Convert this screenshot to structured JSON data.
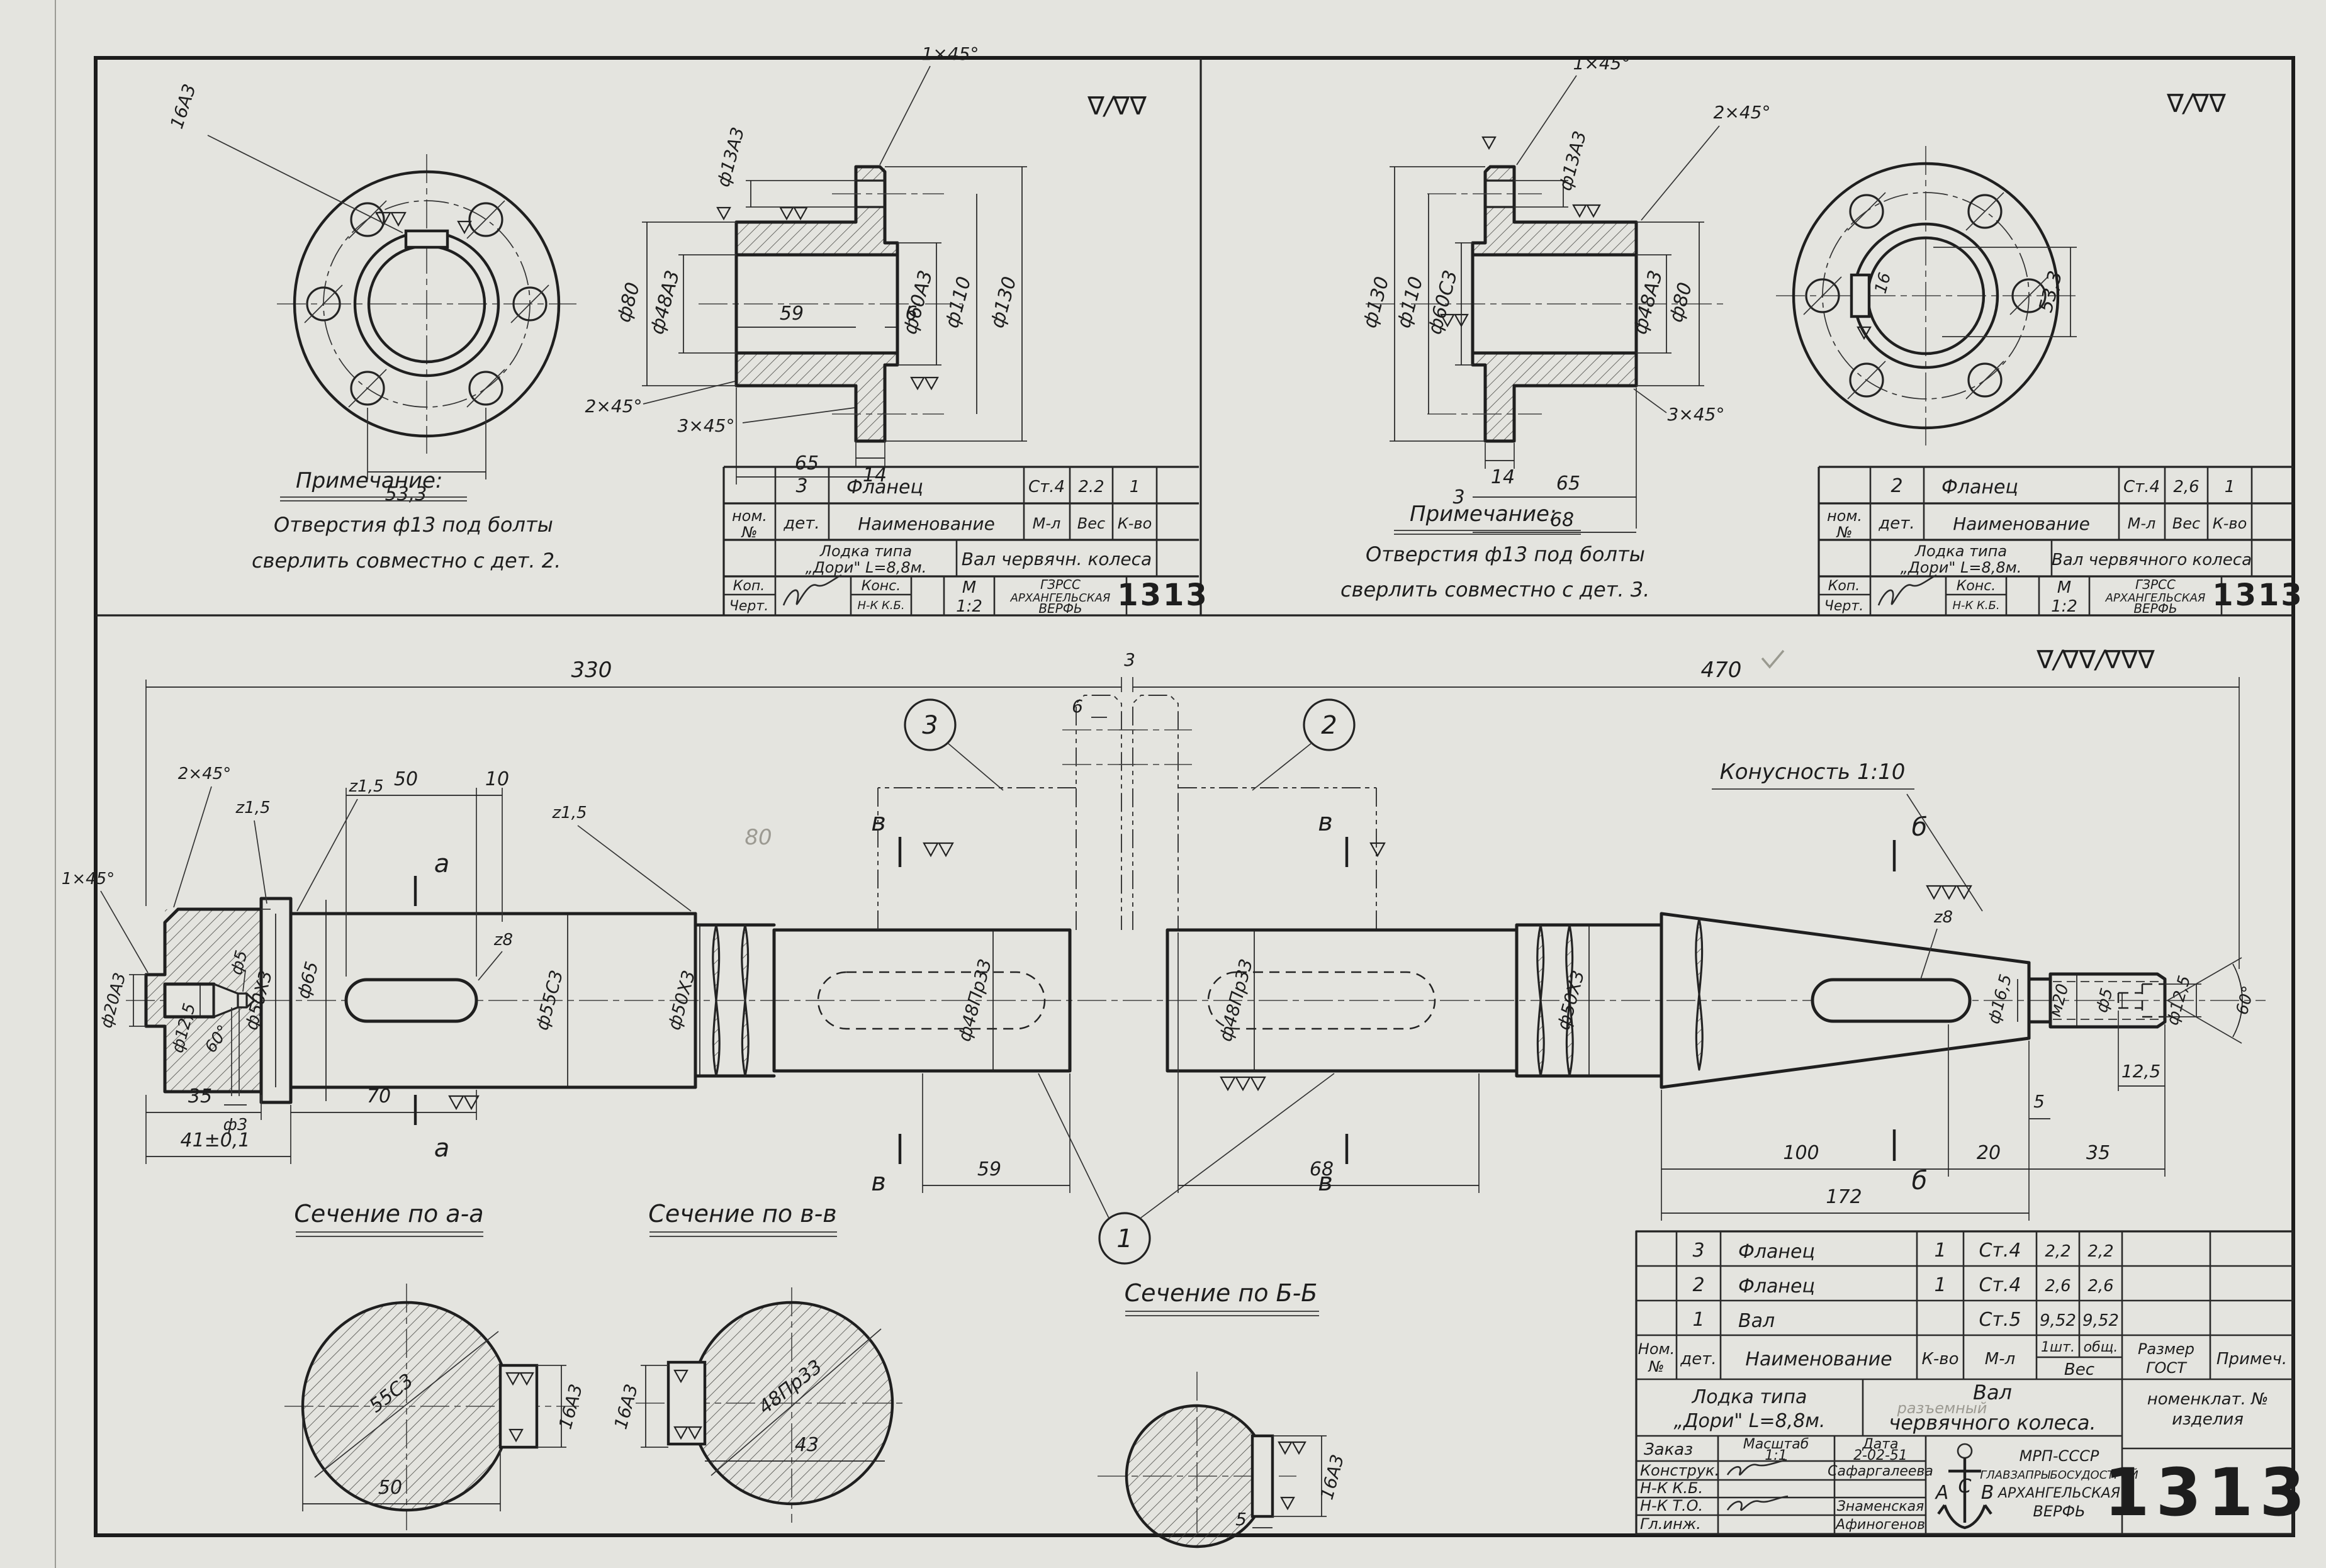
{
  "finish": {
    "tl": "∇/∇∇",
    "tr": "∇/∇∇",
    "main": "∇/∇∇/∇∇∇"
  },
  "flange3": {
    "note": {
      "title": "Примечание:",
      "line1": "Отверстия ф13 под болты",
      "line2": "сверлить совместно с дет. 2."
    },
    "front": {
      "bolt_dim": "53,3",
      "keyway_dim": "16А3"
    },
    "section": {
      "chamfer1": "1×45°",
      "hole": "ф13А3",
      "d80": "ф80",
      "d48": "ф48А3",
      "len59": "59",
      "len6": "6",
      "d60": "ф60А3",
      "d110": "ф110",
      "d130": "ф130",
      "chamfer2": "2×45°",
      "chamfer3": "3×45°",
      "len14": "14",
      "len65": "65"
    },
    "tb": {
      "num": "3",
      "name": "Фланец",
      "mat": "Ст.4",
      "weight": "2.2",
      "qty": "1",
      "h_nom": "ном.",
      "h_no": "№",
      "h_det": "дет.",
      "h_name": "Наименование",
      "h_mat": "М-л",
      "h_ves": "Вес",
      "h_kvo": "К-во",
      "proj1": "Лодка типа",
      "proj2": "„Дори\" L=8,8м.",
      "part": "Вал червячн. колеса",
      "kop": "Коп.",
      "chert": "Черт.",
      "kons": "Конс.",
      "nkkb": "Н-К К.Б.",
      "m": "М",
      "scale": "1:2",
      "org1": "ГЗРСС",
      "org2": "АРХАНГЕЛЬСКАЯ",
      "org3": "ВЕРФЬ",
      "number": "1313"
    }
  },
  "flange2": {
    "note": {
      "title": "Примечание:",
      "line1": "Отверстия ф13 под болты",
      "line2": "сверлить совместно с дет. 3."
    },
    "front": {
      "bolt_dim": "53,3",
      "keyway_dim": "16"
    },
    "section": {
      "chamfer1": "1×45°",
      "hole": "ф13А3",
      "chamfer2": "2×45°",
      "d130": "ф130",
      "d110": "ф110",
      "d60": "ф60С3",
      "d48": "ф48А3",
      "d80": "ф80",
      "chamfer3": "3×45°",
      "len14": "14",
      "len3": "3",
      "len65": "65",
      "len68": "68"
    },
    "tb": {
      "num": "2",
      "name": "Фланец",
      "mat": "Ст.4",
      "weight": "2,6",
      "qty": "1",
      "h_nom": "ном.",
      "h_no": "№",
      "h_det": "дет.",
      "h_name": "Наименование",
      "h_mat": "М-л",
      "h_ves": "Вес",
      "h_kvo": "К-во",
      "proj1": "Лодка типа",
      "proj2": "„Дори\" L=8,8м.",
      "part": "Вал червячного колеса",
      "kop": "Коп.",
      "chert": "Черт.",
      "kons": "Конс.",
      "nkkb": "Н-К К.Б.",
      "m": "М",
      "scale": "1:2",
      "org1": "ГЗРСС",
      "org2": "АРХАНГЕЛЬСКАЯ",
      "org3": "ВЕРФЬ",
      "number": "1313"
    }
  },
  "shaft": {
    "top": {
      "len330": "330",
      "gap3": "3",
      "len6": "6",
      "len470": "470"
    },
    "balloons": {
      "b1": "1",
      "b2": "2",
      "b3": "3"
    },
    "left": {
      "c2x45": "2×45°",
      "r15a": "z1,5",
      "r15b": "z1,5",
      "r15c": "z1,5",
      "c1x45": "1×45°",
      "d20": "ф20А3",
      "d125": "ф12,5",
      "d5": "ф5",
      "a60": "60°",
      "d3": "ф3",
      "d50": "ф50Х3",
      "d65": "ф65",
      "d55": "ф55С3",
      "r8": "z8",
      "len50": "50",
      "len10": "10",
      "len35": "35",
      "len70": "70",
      "len41": "41±0,1",
      "sec_a": "а"
    },
    "mid": {
      "d48a": "ф48Пр33",
      "d48b": "ф48Пр33",
      "d50c": "ф50Х3",
      "len59": "59",
      "len68": "68",
      "sec_v": "в",
      "pencil": "80"
    },
    "right": {
      "taper": "Конусность 1:10",
      "r8": "z8",
      "sec_b": "б",
      "d165": "ф16,5",
      "m20": "м20",
      "d5": "ф5",
      "d125": "ф12,5",
      "a60": "60°",
      "len125": "12,5",
      "len5": "5",
      "len100": "100",
      "len20": "20",
      "len35": "35",
      "len172": "172"
    }
  },
  "sections": {
    "aa": {
      "label": "Сечение по а-а",
      "dia": "55С3",
      "width": "50",
      "key": "16А3"
    },
    "vv": {
      "label": "Сечение по в-в",
      "dia": "48Пр33",
      "width": "43",
      "key": "16А3"
    },
    "bb": {
      "label": "Сечение по Б-Б",
      "key": "16А3",
      "depth": "5"
    }
  },
  "tb": {
    "rows": [
      {
        "det": "3",
        "name": "Фланец",
        "qty": "1",
        "mat": "Ст.4",
        "w1": "2,2",
        "w2": "2,2"
      },
      {
        "det": "2",
        "name": "Фланец",
        "qty": "1",
        "mat": "Ст.4",
        "w1": "2,6",
        "w2": "2,6"
      },
      {
        "det": "1",
        "name": "Вал",
        "qty": "",
        "mat": "Ст.5",
        "w1": "9,52",
        "w2": "9,52"
      }
    ],
    "headers": {
      "nom": "Ном.",
      "no": "№",
      "det": "дет.",
      "name": "Наименование",
      "kvo": "К-во",
      "ml": "М-л",
      "sht": "1шт.",
      "obsh": "общ.",
      "ves": "Вес",
      "razmer": "Размер",
      "gost": "ГОСТ",
      "primech": "Примеч.",
      "nomen1": "номенклат. №",
      "nomen2": "изделия"
    },
    "project": {
      "l1": "Лодка типа",
      "l2": "„Дори\" L=8,8м."
    },
    "part": {
      "l1": "Вал",
      "l2": "червячного колеса.",
      "pencil": "разъемный"
    },
    "bottom": {
      "zakaz": "Заказ",
      "masshtab": "Масштаб",
      "scale": "1:1",
      "data": "Дата",
      "date": "2-02-51",
      "konstruk": "Конструк.",
      "konstruk_name": "Сафаргалеева",
      "nkkb": "Н-К К.Б.",
      "nkto": "Н-К Т.О.",
      "nkto_name": "Знаменская",
      "glinzh": "Гл.инж.",
      "glinzh_name": "Афиногенов"
    },
    "org": {
      "a": "А",
      "c": "С",
      "v": "В",
      "l1": "МРП-СССР",
      "l2": "ГЛАВЗАПРЫБОСУДОСТРОЙ",
      "l3": "АРХАНГЕЛЬСКАЯ",
      "l4": "ВЕРФЬ"
    },
    "number": "1313"
  }
}
